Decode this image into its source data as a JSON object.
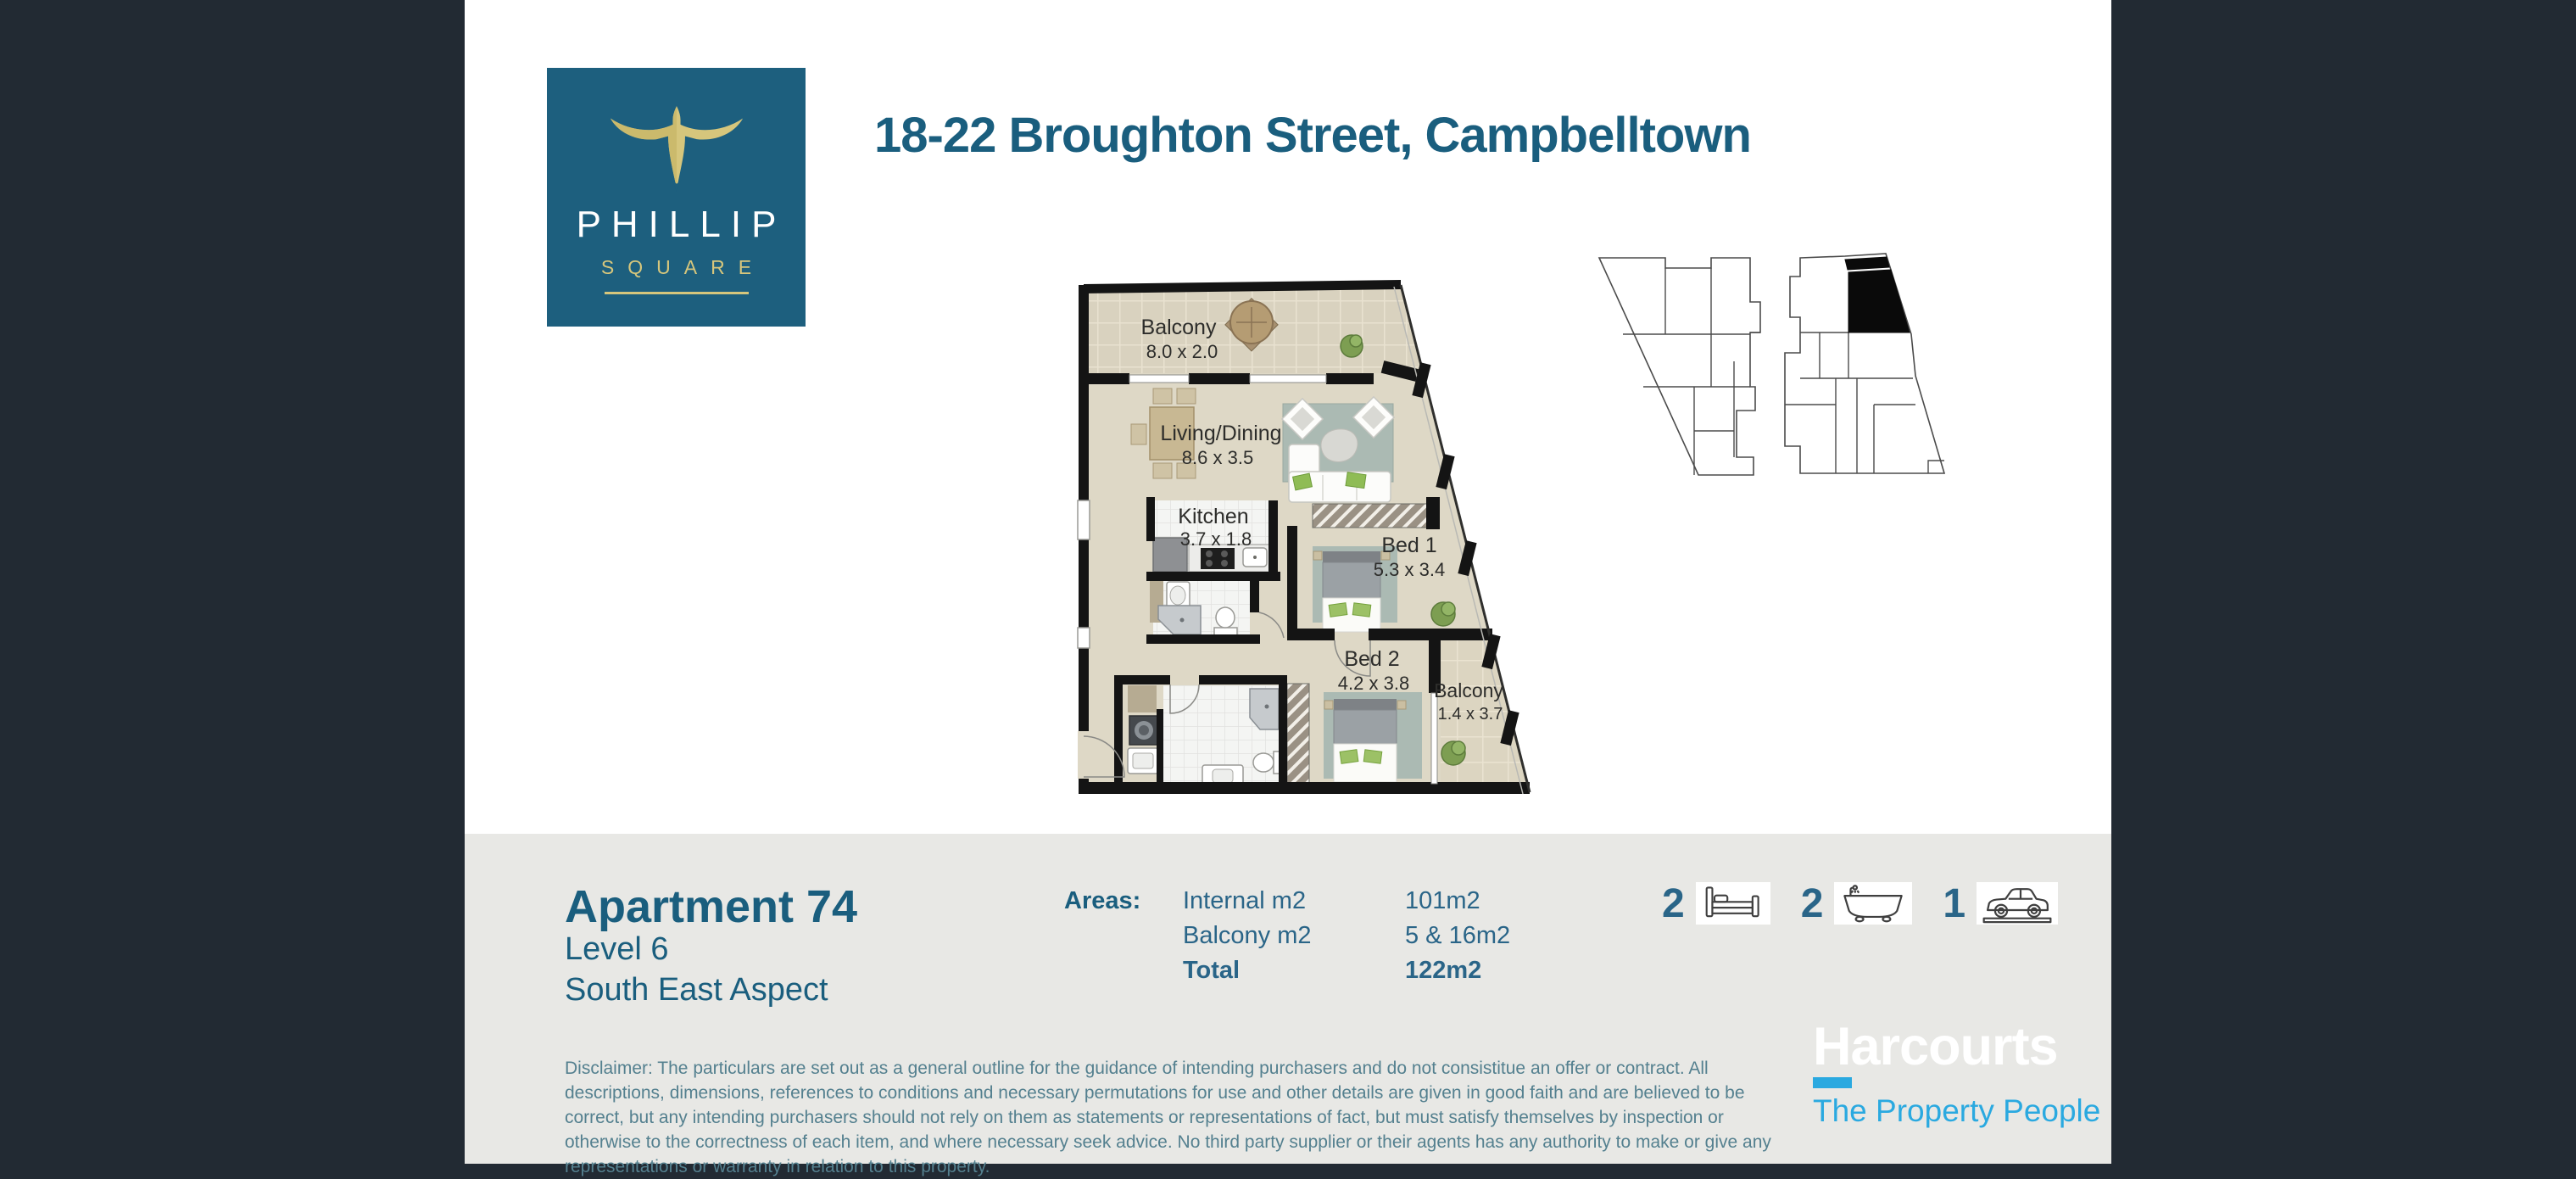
{
  "colors": {
    "background_dark": "#222A33",
    "brand_teal": "#1D5F7E",
    "brand_gold": "#D6C67C",
    "accent_cyan": "#2AA9E0",
    "footer_gray": "#E8E8E5",
    "text_teal": "#2A6588",
    "keyplan_highlight": "#0A0A0A"
  },
  "brand": {
    "name": "PHILLIP",
    "sub": "SQUARE"
  },
  "header": {
    "title": "18-22 Broughton Street, Campbelltown"
  },
  "floorplan": {
    "rooms": [
      {
        "name": "Balcony",
        "dims": "8.0 x 2.0"
      },
      {
        "name": "Living/Dining",
        "dims": "8.6 x 3.5"
      },
      {
        "name": "Kitchen",
        "dims": "3.7 x 1.8"
      },
      {
        "name": "Bed 1",
        "dims": "5.3 x 3.4"
      },
      {
        "name": "Bed 2",
        "dims": "4.2 x 3.8"
      },
      {
        "name": "Balcony",
        "dims": "1.4 x 3.7"
      }
    ]
  },
  "details": {
    "apartment": "Apartment 74",
    "level": "Level 6",
    "aspect": "South East Aspect"
  },
  "areas": {
    "label": "Areas:",
    "rows": [
      {
        "name": "Internal m2",
        "value": "101m2"
      },
      {
        "name": "Balcony m2",
        "value": "5 & 16m2"
      },
      {
        "name": "Total",
        "value": "122m2"
      }
    ]
  },
  "features": [
    {
      "icon": "bed-icon",
      "count": "2"
    },
    {
      "icon": "bath-icon",
      "count": "2"
    },
    {
      "icon": "car-icon",
      "count": "1"
    }
  ],
  "disclaimer": "Disclaimer: The particulars are set out as a general outline for the guidance of intending purchasers and do not consistitue an offer or contract. All descriptions, dimensions, references to conditions and necessary permutations for use and other details are given in good faith and are believed to be correct, but any intending purchasers should not rely on them as statements or representations of fact, but must satisfy themselves by inspection or otherwise to the correctness of each item, and where necessary seek advice. No third party supplier or their agents has any authority to make or give any representations or warranty in relation to this property.",
  "agency": {
    "name": "Harcourts",
    "tagline": "The Property People"
  }
}
